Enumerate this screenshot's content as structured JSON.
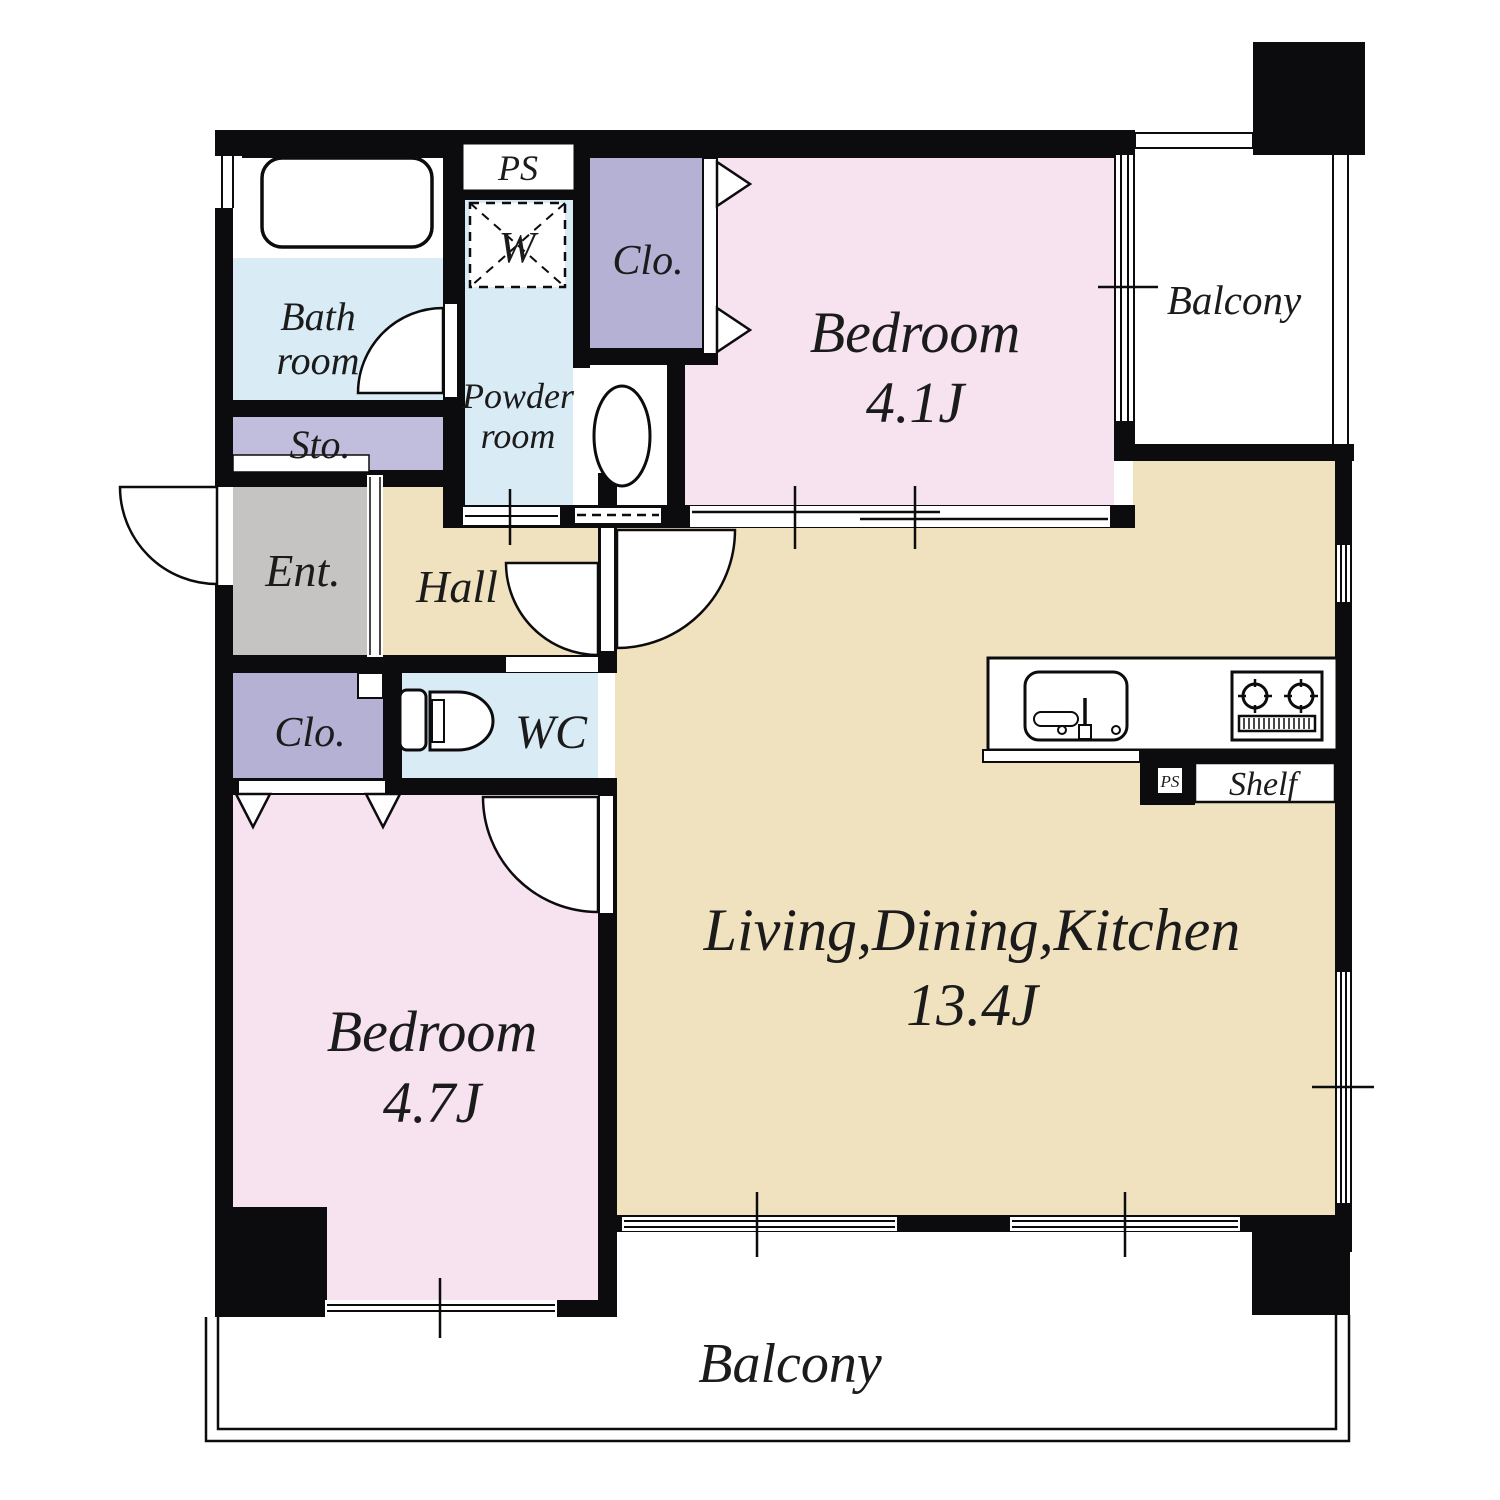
{
  "colors": {
    "wall": "#0c0b0d",
    "bedroom_pink": "#f7e2f0",
    "ldk_tan": "#f1e2bf",
    "water_blue": "#d9ecf6",
    "closet_lavender": "#b4b1d4",
    "storage_lavender": "#c1bedd",
    "entrance_gray": "#c6c4c2",
    "white": "#ffffff",
    "text": "#1b1b1b"
  },
  "rooms": {
    "bedroom_top": {
      "label": "Bedroom",
      "area": "4.1J"
    },
    "bedroom_bottom": {
      "label": "Bedroom",
      "area": "4.7J"
    },
    "ldk": {
      "label": "Living,Dining,Kitchen",
      "area": "13.4J"
    },
    "balcony_top": {
      "label": "Balcony"
    },
    "balcony_bottom": {
      "label": "Balcony"
    },
    "bathroom": {
      "line1": "Bath",
      "line2": "room"
    },
    "powder_room": {
      "line1": "Powder",
      "line2": "room"
    },
    "hall": {
      "label": "Hall"
    },
    "entrance": {
      "label": "Ent."
    },
    "storage": {
      "label": "Sto."
    },
    "closet_upper": {
      "label": "Clo."
    },
    "closet_lower": {
      "label": "Clo."
    },
    "wc": {
      "label": "WC"
    },
    "pipe_space_top": {
      "label": "PS"
    },
    "pipe_space_kitchen": {
      "label": "PS"
    },
    "washing_machine": {
      "label": "W"
    },
    "shelf": {
      "label": "Shelf"
    }
  }
}
